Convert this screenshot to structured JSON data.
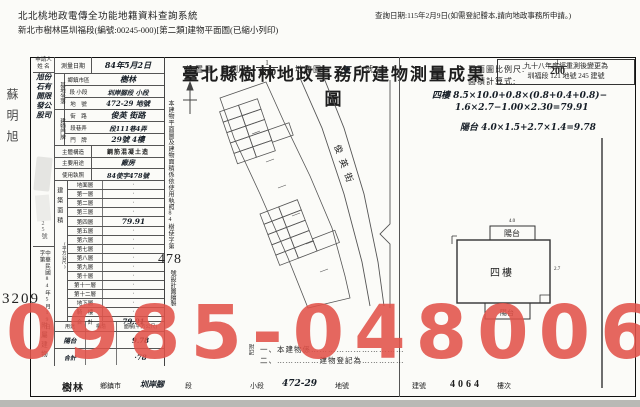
{
  "header": {
    "system_title": "北北桃地政電傳全功能地籍資料查詢系統",
    "query_date": "查詢日期:115年2月9日(如需登記謄本,請向地政事務所申請。)",
    "doc_line": "新北市樹林區圳福段(編號:00245-000)[第二類]建物平面圖(已縮小列印)"
  },
  "title": "臺北縣樹林地政事務所建物測量成果圖",
  "remeasure_note": {
    "line1": "九十八年度經重測後變更為",
    "line2": "圳福段 121 地號 245 建號"
  },
  "side_margin": {
    "stamp_name": "蘇明旭",
    "receipt_big_no": "3209"
  },
  "applicant": {
    "label_line1": "申請人",
    "label_line2": "姓 名",
    "name_right": "旭石開發股",
    "name_left": "份有限公司",
    "address_visible": "25號",
    "receipt_date": "中華民國84年5月19日",
    "receipt_word": "字第",
    "receipt_suffix": "號"
  },
  "form": {
    "survey_date_label": "測量日期",
    "survey_date_value": "84年5月2日",
    "site_group": "基地坐落",
    "site_rows": [
      {
        "label": "鄉鎮市區",
        "value": "樹林"
      },
      {
        "label": "段 小段",
        "value": "圳岸腳段 小段"
      },
      {
        "label": "地　號",
        "value": "472-29 地號"
      }
    ],
    "door_group": "建物門牌",
    "door_rows": [
      {
        "label": "街　路",
        "value": "俊英 街路"
      },
      {
        "label": "段巷弄",
        "value": "段111巷4弄"
      },
      {
        "label": "門　牌",
        "value": "29號 4樓"
      }
    ],
    "structure_label": "主體構造",
    "structure_value": "鋼筋混凝土造",
    "usage_label": "主要用途",
    "usage_value": "廠房",
    "license_label": "使用執照",
    "license_value": "84使字478號",
    "floors_group": "建築面積",
    "floors_unit": "(平方公尺)",
    "floors_rows": [
      {
        "label": "地面層",
        "value": "·"
      },
      {
        "label": "第一層",
        "value": "·"
      },
      {
        "label": "第二層",
        "value": "·"
      },
      {
        "label": "第三層",
        "value": "·"
      },
      {
        "label": "第四層",
        "value": "79.91"
      },
      {
        "label": "第五層",
        "value": "·"
      },
      {
        "label": "第六層",
        "value": "·"
      },
      {
        "label": "第七層",
        "value": "·"
      },
      {
        "label": "第八層",
        "value": "·"
      },
      {
        "label": "第九層",
        "value": "·"
      },
      {
        "label": "第十層",
        "value": "·"
      },
      {
        "label": "第十一層",
        "value": "·"
      },
      {
        "label": "第十二層",
        "value": "·"
      },
      {
        "label": "地下層",
        "value": "·"
      },
      {
        "label": "騎　樓",
        "value": "·"
      },
      {
        "label": "合　計",
        "value": "79.91"
      }
    ],
    "attached_group": "附屬建物",
    "attached_headers": [
      "用途",
      "構造",
      "面積(平方公尺)"
    ],
    "attached_rows": [
      {
        "use": "陽台",
        "struct": "",
        "area": "9.78"
      },
      {
        "use": "合計",
        "struct": "",
        "area": "·78"
      }
    ]
  },
  "location_map": {
    "title": "位置圖",
    "scale_label": "比例尺:",
    "scale_num": "1",
    "scale_den": "1200",
    "sheet_label": "地籍圖",
    "sheet_no": "五",
    "sheet_suffix": "號",
    "street_name": "俊英街",
    "side_note_pre": "本建物平面圖及建物面積係依使用執照84樹使字第",
    "side_note_big": "478",
    "side_note_post": "號設計圖繪製"
  },
  "plan": {
    "scale_label": "平面圖比例尺:",
    "scale_num": "1",
    "scale_den": "200",
    "calc_label": "面積計算式:",
    "formula_line1": "四樓 8.5×10.0+0.8×(0.8+0.4+0.8)−",
    "formula_line2": "1.6×2.7−1.00×2.30=79.91",
    "formula_line3": "陽台 4.0×1.5+2.7×1.4=9.78",
    "label_balcony_top": "陽台",
    "label_main": "四樓",
    "label_balcony_bottom": "陽台",
    "dim_top": "4.0",
    "dim_right": "2.7"
  },
  "notes": {
    "label": "附記",
    "line1": "一、本建物係……………………………",
    "line2": "二、……………建物登記為……………"
  },
  "footer": {
    "town": "樹林",
    "town_label": "鄉鎮市",
    "section": "圳岸腳",
    "section_label": "段",
    "subsection_label": "小段",
    "parcel": "472-29",
    "parcel_label": "地號",
    "bno_label": "建號",
    "bno": "4064",
    "floor_label": "樓次"
  },
  "watermark": {
    "text": "0985-048006",
    "color": "#e2534a"
  },
  "colors": {
    "paper": "#fbfbf8",
    "ink": "#1e1e1e",
    "border": "#555555",
    "watermark": "#e2534a"
  }
}
